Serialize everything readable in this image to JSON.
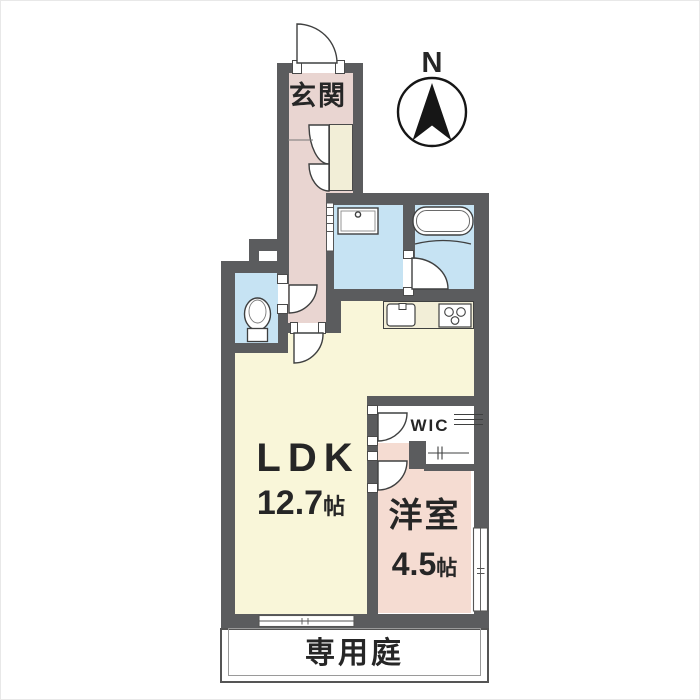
{
  "compass": {
    "north_label": "N"
  },
  "rooms": {
    "genkan": {
      "label": "玄関"
    },
    "ldk": {
      "label": "LDK",
      "size_value": "12.7",
      "size_unit": "帖"
    },
    "western_room": {
      "label": "洋室",
      "size_value": "4.5",
      "size_unit": "帖"
    },
    "wic": {
      "label": "WIC"
    },
    "private_garden": {
      "label": "専用庭"
    }
  },
  "colors": {
    "wall": "#5b5c5e",
    "hallway-floor": "#e9d5d1",
    "western-room-floor": "#f5dcd2",
    "wet-area-floor": "#c6e3f3",
    "ldk-floor": "#f9f6d9",
    "counter-fill": "#f2eed7",
    "line": "#3f4040",
    "text": "#262626"
  }
}
